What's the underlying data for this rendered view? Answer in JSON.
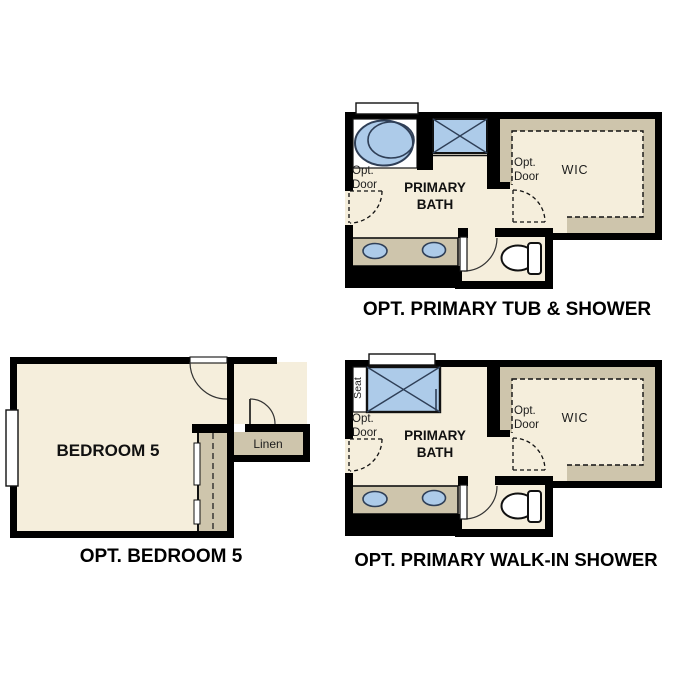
{
  "canvas": {
    "width": 687,
    "height": 687,
    "background": "#ffffff"
  },
  "palette": {
    "wall": "#000000",
    "floor_cream": "#f5eedc",
    "cabinet_tan": "#cec5ac",
    "fixture_blue": "#adcbe9",
    "fixture_outline": "#2f3f57",
    "line_dark": "#111111",
    "label_color": "#1c1c1c"
  },
  "figures": {
    "tub_shower": {
      "title": "OPT. PRIMARY TUB & SHOWER",
      "labels": {
        "opt_door_bath": "Opt. Door",
        "room": "PRIMARY BATH",
        "opt_door_wic": "Opt. Door",
        "wic": "WIC"
      }
    },
    "bedroom5": {
      "title": "OPT. BEDROOM 5",
      "labels": {
        "room": "BEDROOM 5",
        "linen": "Linen"
      }
    },
    "walkin_shower": {
      "title": "OPT. PRIMARY WALK-IN SHOWER",
      "labels": {
        "seat": "Seat",
        "opt_door_bath": "Opt. Door",
        "room": "PRIMARY BATH",
        "opt_door_wic": "Opt. Door",
        "wic": "WIC"
      }
    }
  }
}
